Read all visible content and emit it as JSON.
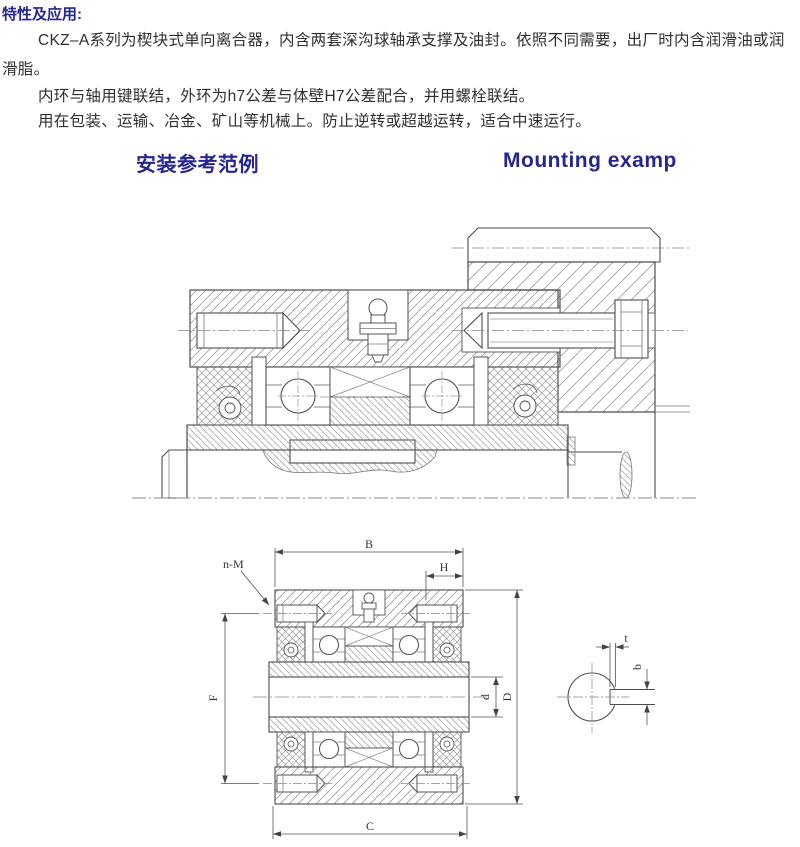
{
  "intro": {
    "title": "特性及应用:",
    "lines": [
      "CKZ–A系列为楔块式单向离合器，内含两套深沟球轴承支撑及油封。依照不同需要，出厂时内含润滑油或润",
      "滑脂。",
      "内环与轴用键联结，外环为h7公差与体壁H7公差配合，并用螺栓联结。",
      "用在包装、运输、冶金、矿山等机械上。防止逆转或超越运转，适合中速运行。"
    ]
  },
  "headings": {
    "zh": "安装参考范例",
    "en": "Mounting examp"
  },
  "dims": {
    "B": "B",
    "H": "H",
    "nM": "n-M",
    "F": "F",
    "d": "d",
    "D": "D",
    "C": "C",
    "t": "t",
    "b": "b"
  },
  "colors": {
    "heading": "#26268c",
    "body_text": "#2f2f2f",
    "outline": "#4d4d4d",
    "hatch": "#999999"
  }
}
